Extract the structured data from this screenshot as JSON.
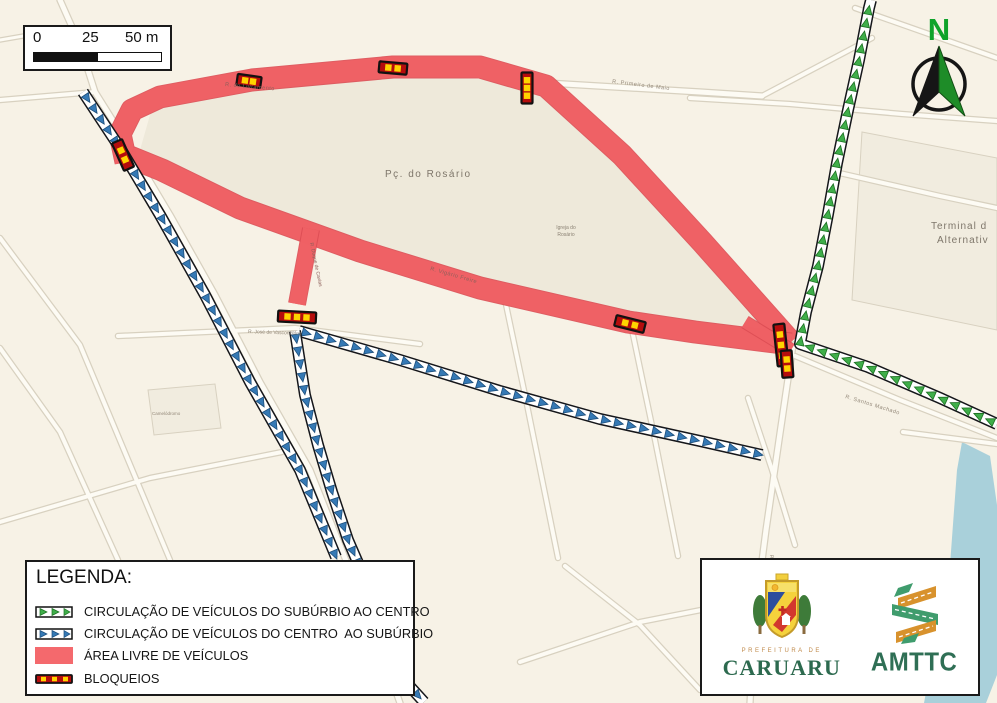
{
  "colors": {
    "bg": "#f7f2e6",
    "plaza": "#eee9da",
    "block_fill": "#f1ecdf",
    "street_fill": "#fdfbf4",
    "street_casing": "#d8d1c0",
    "accent_red": "#f06165",
    "accent_red_casing": "#dc4d53",
    "legend_red": "#f4696d",
    "arrow_green": "#3fae4a",
    "arrow_green_dark": "#1c6f22",
    "arrow_blue": "#3579b5",
    "arrow_blue_dark": "#1d4e7a",
    "blockade_red": "#b50d0d",
    "blockade_yellow": "#ffd400",
    "water": "#a9d0da",
    "caruaru_green": "#2d6a4f",
    "amttc_green": "#2f6f55",
    "amttc_orange": "#d8922d",
    "amttc_ribbon_green": "#3f9c6d",
    "north_green": "#0fa32a"
  },
  "scalebar": {
    "labels": [
      "0",
      "25",
      "50 m"
    ]
  },
  "north_arrow": {
    "label": "N"
  },
  "legend": {
    "title": "LEGENDA:",
    "items": [
      {
        "symbol": "green-arrows",
        "label": "CIRCULAÇÃO DE VEÍCULOS DO SUBÚRBIO AO CENTRO"
      },
      {
        "symbol": "blue-arrows",
        "label": "CIRCULAÇÃO DE VEÍCULOS DO CENTRO  AO SUBÚRBIO"
      },
      {
        "symbol": "red-area",
        "label": "ÁREA LIVRE DE VEÍCULOS"
      },
      {
        "symbol": "blockade",
        "label": "BLOQUEIOS"
      }
    ]
  },
  "logos": {
    "prefeitura": "PREFEITURA DE",
    "caruaru": "CARUARU",
    "amttc": "AMTTC"
  },
  "map": {
    "place_labels": [
      {
        "text": "Pç. do Rosário",
        "x": 385,
        "y": 177,
        "size": 10,
        "rot": 0,
        "ls": 1.5,
        "color": "#7e766a"
      },
      {
        "text": "Igreja do",
        "x": 566,
        "y": 229,
        "size": 5,
        "rot": 0,
        "ls": 0,
        "color": "#8b8274",
        "anchor": "middle"
      },
      {
        "text": "Rosário",
        "x": 566,
        "y": 236,
        "size": 5,
        "rot": 0,
        "ls": 0,
        "color": "#8b8274",
        "anchor": "middle"
      },
      {
        "text": "Terminal d",
        "x": 931,
        "y": 229,
        "size": 10,
        "rot": 0,
        "ls": 1,
        "color": "#7e766a"
      },
      {
        "text": "Alternativ",
        "x": 937,
        "y": 243,
        "size": 10,
        "rot": 0,
        "ls": 1,
        "color": "#7e766a"
      },
      {
        "text": "R. do Livramento",
        "x": 225,
        "y": 86,
        "size": 5.5,
        "rot": 5,
        "ls": 0.5,
        "color": "#8d5f5a"
      },
      {
        "text": "R. Primeiro de Maio",
        "x": 612,
        "y": 83,
        "size": 5.5,
        "rot": 7,
        "ls": 0.5,
        "color": "#94897a"
      },
      {
        "text": "R. Vigário Freire",
        "x": 430,
        "y": 270,
        "size": 5.5,
        "rot": 16,
        "ls": 0.5,
        "color": "#8d5f5a"
      },
      {
        "text": "R. Duque de Caxias",
        "x": 310,
        "y": 243,
        "size": 5,
        "rot": 78,
        "ls": 0,
        "color": "#8d5f5a"
      },
      {
        "text": "R. José de Vasconcelos",
        "x": 248,
        "y": 333,
        "size": 5,
        "rot": 2,
        "ls": 0,
        "color": "#94897a"
      },
      {
        "text": "R. Santos Machado",
        "x": 845,
        "y": 398,
        "size": 5.5,
        "rot": 17,
        "ls": 0.5,
        "color": "#94897a"
      },
      {
        "text": "R. Silvino Macedo",
        "x": 770,
        "y": 555,
        "size": 5,
        "rot": 83,
        "ls": 0,
        "color": "#94897a"
      },
      {
        "text": "Camelódromo",
        "x": 152,
        "y": 415,
        "size": 4.5,
        "rot": 0,
        "ls": 0,
        "color": "#94897a"
      }
    ],
    "blocks": [
      {
        "points": [
          [
            148,
            390
          ],
          [
            215,
            384
          ],
          [
            221,
            428
          ],
          [
            154,
            435
          ]
        ]
      },
      {
        "points": [
          [
            862,
            132
          ],
          [
            997,
            158
          ],
          [
            997,
            330
          ],
          [
            852,
            300
          ]
        ]
      }
    ],
    "plaza": {
      "points": [
        [
          140,
          150
        ],
        [
          152,
          108
        ],
        [
          255,
          90
        ],
        [
          400,
          77
        ],
        [
          480,
          79
        ],
        [
          546,
          90
        ],
        [
          622,
          162
        ],
        [
          702,
          247
        ],
        [
          782,
          340
        ],
        [
          640,
          317
        ],
        [
          480,
          283
        ],
        [
          300,
          231
        ],
        [
          180,
          177
        ]
      ]
    },
    "water": {
      "points": [
        [
          962,
          442
        ],
        [
          990,
          456
        ],
        [
          997,
          505
        ],
        [
          997,
          675
        ],
        [
          986,
          703
        ],
        [
          924,
          703
        ],
        [
          950,
          565
        ],
        [
          957,
          470
        ]
      ]
    },
    "streets": [
      {
        "points": [
          [
            60,
            0
          ],
          [
            80,
            45
          ],
          [
            95,
            92
          ],
          [
            130,
            148
          ],
          [
            170,
            215
          ],
          [
            215,
            295
          ],
          [
            260,
            382
          ],
          [
            310,
            470
          ],
          [
            345,
            558
          ],
          [
            372,
            625
          ],
          [
            400,
            703
          ]
        ],
        "w": 5
      },
      {
        "points": [
          [
            0,
            100
          ],
          [
            95,
            92
          ]
        ],
        "w": 4
      },
      {
        "points": [
          [
            548,
            83
          ],
          [
            700,
            92
          ],
          [
            762,
            96
          ]
        ],
        "w": 5
      },
      {
        "points": [
          [
            762,
            96
          ],
          [
            872,
            38
          ]
        ],
        "w": 4
      },
      {
        "points": [
          [
            690,
            98
          ],
          [
            790,
            104
          ],
          [
            902,
            114
          ],
          [
            997,
            121
          ]
        ],
        "w": 4
      },
      {
        "points": [
          [
            855,
            8
          ],
          [
            997,
            58
          ]
        ],
        "w": 4
      },
      {
        "points": [
          [
            793,
            345
          ],
          [
            779,
            440
          ],
          [
            766,
            530
          ],
          [
            755,
            615
          ],
          [
            750,
            703
          ]
        ],
        "w": 5
      },
      {
        "points": [
          [
            795,
            356
          ],
          [
            900,
            400
          ],
          [
            997,
            438
          ]
        ],
        "w": 4
      },
      {
        "points": [
          [
            903,
            432
          ],
          [
            997,
            444
          ]
        ],
        "w": 4
      },
      {
        "points": [
          [
            835,
            172
          ],
          [
            940,
            196
          ],
          [
            997,
            208
          ]
        ],
        "w": 4
      },
      {
        "points": [
          [
            0,
            238
          ],
          [
            80,
            345
          ],
          [
            170,
            560
          ]
        ],
        "w": 4
      },
      {
        "points": [
          [
            0,
            348
          ],
          [
            60,
            432
          ],
          [
            118,
            560
          ]
        ],
        "w": 4
      },
      {
        "points": [
          [
            118,
            336
          ],
          [
            295,
            328
          ],
          [
            420,
            344
          ]
        ],
        "w": 4
      },
      {
        "points": [
          [
            0,
            522
          ],
          [
            150,
            478
          ],
          [
            282,
            452
          ]
        ],
        "w": 4
      },
      {
        "points": [
          [
            505,
            300
          ],
          [
            525,
            395
          ],
          [
            558,
            558
          ]
        ],
        "w": 4
      },
      {
        "points": [
          [
            632,
            330
          ],
          [
            655,
            440
          ],
          [
            678,
            556
          ]
        ],
        "w": 4
      },
      {
        "points": [
          [
            565,
            566
          ],
          [
            640,
            625
          ],
          [
            700,
            690
          ]
        ],
        "w": 4
      },
      {
        "points": [
          [
            520,
            662
          ],
          [
            640,
            622
          ],
          [
            762,
            598
          ]
        ],
        "w": 4
      },
      {
        "points": [
          [
            748,
            398
          ],
          [
            772,
            470
          ],
          [
            795,
            545
          ]
        ],
        "w": 4
      },
      {
        "points": [
          [
            0,
            40
          ],
          [
            58,
            30
          ]
        ],
        "w": 3
      }
    ],
    "red_routes": [
      {
        "points": [
          [
            126,
            162
          ],
          [
            120,
            134
          ],
          [
            132,
            110
          ],
          [
            160,
            97
          ],
          [
            252,
            80
          ],
          [
            393,
            67
          ],
          [
            480,
            67
          ],
          [
            546,
            86
          ],
          [
            622,
            155
          ],
          [
            702,
            242
          ],
          [
            791,
            342
          ]
        ],
        "w": 21
      },
      {
        "points": [
          [
            791,
            344
          ],
          [
            695,
            332
          ],
          [
            628,
            322
          ],
          [
            480,
            288
          ],
          [
            360,
            251
          ],
          [
            240,
            208
          ],
          [
            162,
            170
          ],
          [
            130,
            157
          ]
        ],
        "w": 21
      },
      {
        "points": [
          [
            311,
            229
          ],
          [
            297,
            304
          ]
        ],
        "w": 16
      },
      {
        "points": [
          [
            791,
            350
          ],
          [
            745,
            322
          ]
        ],
        "w": 12
      }
    ],
    "arrow_routes": [
      {
        "kind": "green",
        "points": [
          [
            997,
            424
          ],
          [
            940,
            398
          ],
          [
            868,
            367
          ],
          [
            800,
            344
          ],
          [
            806,
            312
          ],
          [
            818,
            266
          ],
          [
            828,
            214
          ],
          [
            837,
            163
          ],
          [
            848,
            110
          ],
          [
            859,
            60
          ],
          [
            869,
            8
          ],
          [
            871,
            0
          ]
        ]
      },
      {
        "kind": "blue",
        "points": [
          [
            83,
            92
          ],
          [
            120,
            148
          ],
          [
            160,
            215
          ],
          [
            205,
            295
          ],
          [
            250,
            382
          ],
          [
            300,
            470
          ],
          [
            336,
            557
          ]
        ]
      },
      {
        "kind": "blue",
        "points": [
          [
            299,
            331
          ],
          [
            400,
            360
          ],
          [
            500,
            391
          ],
          [
            600,
            419
          ],
          [
            700,
            441
          ],
          [
            762,
            455
          ]
        ]
      },
      {
        "kind": "blue",
        "points": [
          [
            295,
            331
          ],
          [
            305,
            395
          ],
          [
            318,
            445
          ],
          [
            332,
            492
          ],
          [
            348,
            540
          ],
          [
            358,
            563
          ]
        ]
      },
      {
        "kind": "blue",
        "points": [
          [
            404,
            680
          ],
          [
            424,
            702
          ]
        ]
      }
    ],
    "blockades": [
      {
        "x": 123,
        "y": 155,
        "rot": 66,
        "len": 30,
        "dots": 2
      },
      {
        "x": 249,
        "y": 81,
        "rot": 8,
        "len": 24,
        "dots": 2
      },
      {
        "x": 393,
        "y": 68,
        "rot": 5,
        "len": 28,
        "dots": 2
      },
      {
        "x": 527,
        "y": 88,
        "rot": 90,
        "len": 31,
        "dots": 3
      },
      {
        "x": 630,
        "y": 324,
        "rot": 14,
        "len": 30,
        "dots": 2
      },
      {
        "x": 781,
        "y": 345,
        "rot": 84,
        "len": 42,
        "dots": 3
      },
      {
        "x": 787,
        "y": 364,
        "rot": 86,
        "len": 27,
        "dots": 2
      },
      {
        "x": 297,
        "y": 317,
        "rot": 3,
        "len": 38,
        "dots": 3
      }
    ]
  }
}
